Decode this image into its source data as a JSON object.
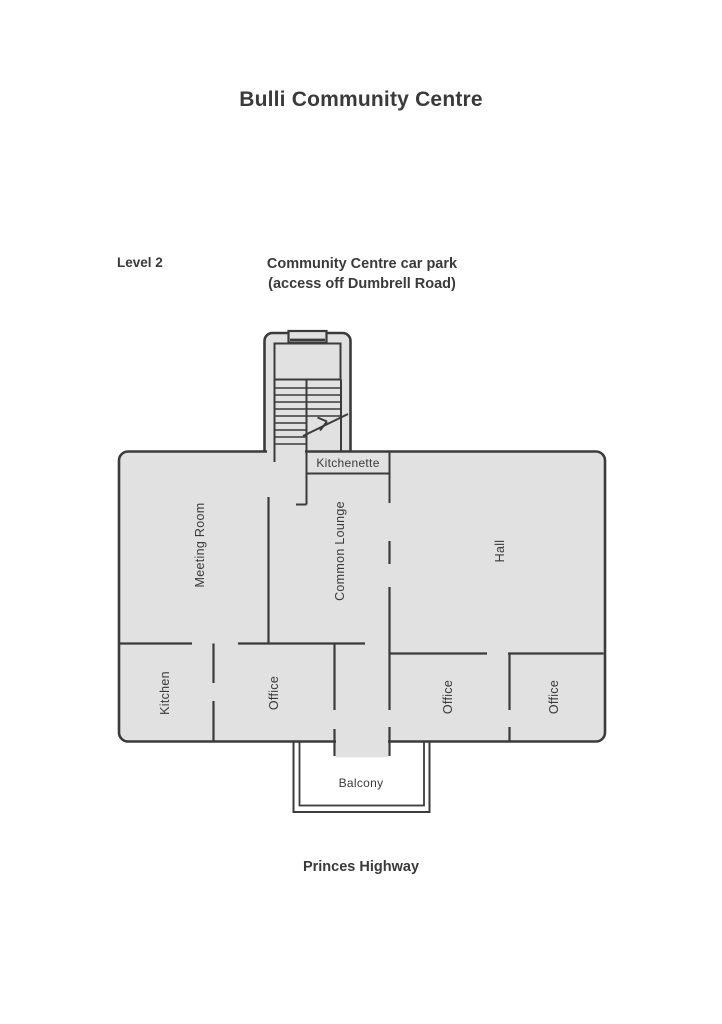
{
  "header": {
    "title": "Bulli Community Centre"
  },
  "annotations": {
    "level_label": "Level 2",
    "car_park_line1": "Community Centre car park",
    "car_park_line2": "(access off Dumbrell Road)",
    "road_label": "Princes Highway"
  },
  "plan": {
    "rooms": [
      {
        "id": "meeting-room",
        "label": "Meeting Room",
        "orientation": "vertical"
      },
      {
        "id": "common-lounge",
        "label": "Common Lounge",
        "orientation": "vertical"
      },
      {
        "id": "hall",
        "label": "Hall",
        "orientation": "vertical"
      },
      {
        "id": "kitchenette",
        "label": "Kitchenette",
        "orientation": "horizontal"
      },
      {
        "id": "kitchen",
        "label": "Kitchen",
        "orientation": "vertical"
      },
      {
        "id": "office-1",
        "label": "Office",
        "orientation": "vertical"
      },
      {
        "id": "office-2",
        "label": "Office",
        "orientation": "vertical"
      },
      {
        "id": "office-3",
        "label": "Office",
        "orientation": "vertical"
      },
      {
        "id": "balcony",
        "label": "Balcony",
        "orientation": "horizontal"
      }
    ],
    "features": [
      "stair-tower",
      "stair-direction-arrow",
      "balcony-double-rail"
    ]
  },
  "colors": {
    "room-fill": "#e1e1e1",
    "wall": "#3b3b3b",
    "text": "#3a3a3a",
    "background": "#ffffff"
  }
}
